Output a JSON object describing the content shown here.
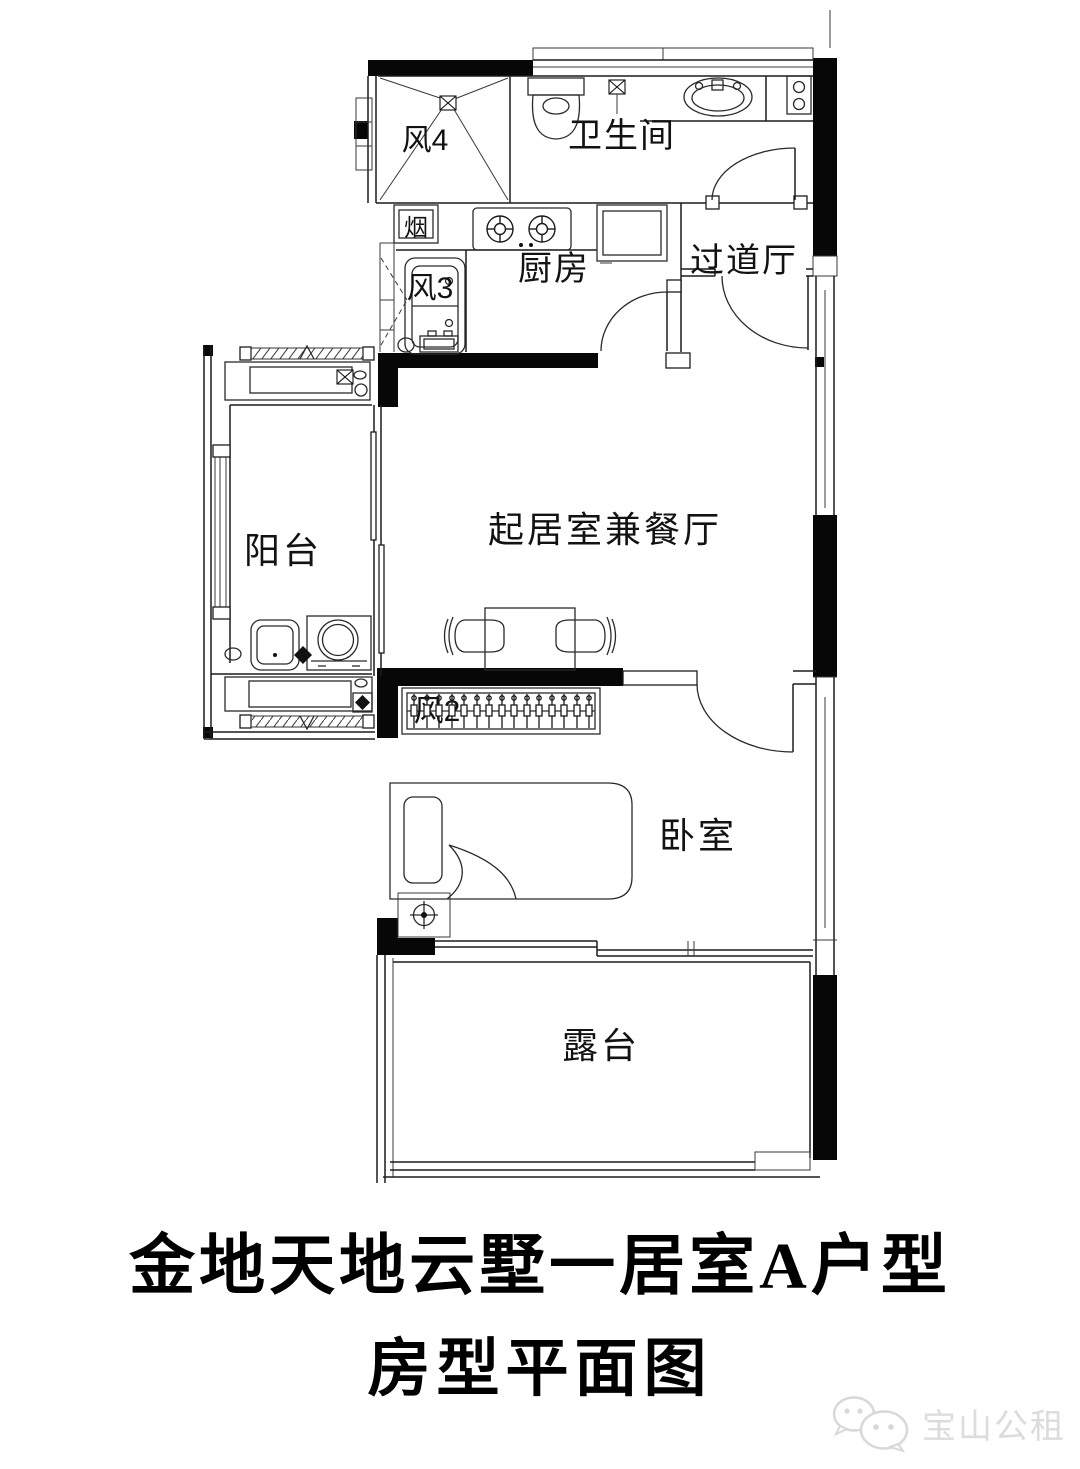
{
  "title": {
    "line1": "金地天地云墅一居室A户型",
    "line2": "房型平面图"
  },
  "rooms": {
    "bathroom": "卫生间",
    "kitchen": "厨房",
    "hallway": "过道厅",
    "balcony": "阳台",
    "living": "起居室兼餐厅",
    "bedroom": "卧室",
    "terrace": "露台"
  },
  "shafts": {
    "wind4": "风4",
    "wind3": "风3",
    "wind2": "风2",
    "flue": "烟"
  },
  "watermark": {
    "label": "宝山公租",
    "icon": "wechat-icon"
  },
  "colors": {
    "wall": "#070707",
    "line": "#1c1c1c",
    "watermark": "#dcdcdc"
  }
}
